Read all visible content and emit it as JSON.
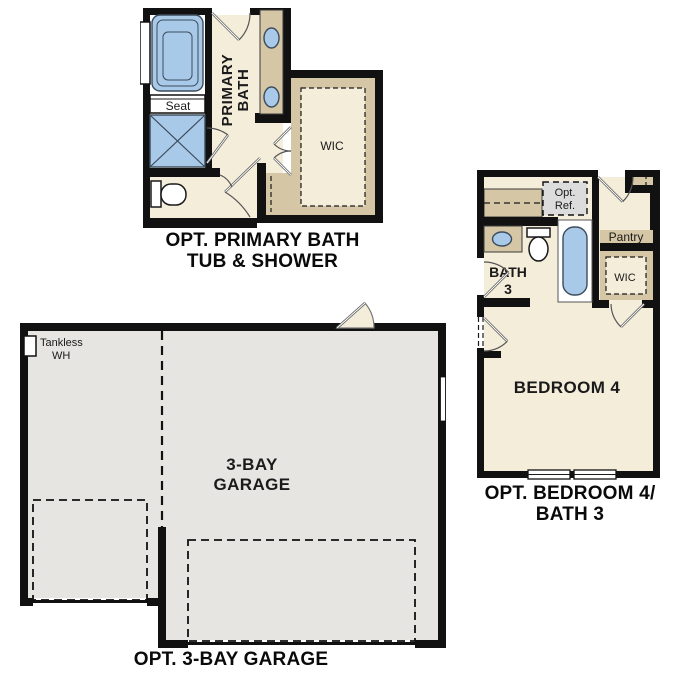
{
  "page": {
    "background": "#ffffff"
  },
  "colors": {
    "wall": "#111111",
    "floor_cream": "#f4edda",
    "counter_tan": "#d5c6a6",
    "fixture_blue": "#a9c9e9",
    "garage_gray": "#e6e5e2",
    "ref_gray": "#dcdcdc"
  },
  "plans": {
    "primary_bath": {
      "caption_line1": "OPT. PRIMARY BATH",
      "caption_line2": "TUB & SHOWER",
      "labels": {
        "room_line1": "PRIMARY",
        "room_line2": "BATH",
        "seat": "Seat",
        "wic": "WIC"
      }
    },
    "bedroom4": {
      "caption_line1": "OPT. BEDROOM 4/",
      "caption_line2": "BATH 3",
      "labels": {
        "opt_ref_line1": "Opt.",
        "opt_ref_line2": "Ref.",
        "bath_line1": "BATH",
        "bath_line2": "3",
        "pantry": "Pantry",
        "wic": "WIC",
        "bedroom": "BEDROOM 4"
      }
    },
    "garage": {
      "caption": "OPT. 3-BAY GARAGE",
      "labels": {
        "tankless_line1": "Tankless",
        "tankless_line2": "WH",
        "garage_line1": "3-BAY",
        "garage_line2": "GARAGE"
      }
    }
  }
}
